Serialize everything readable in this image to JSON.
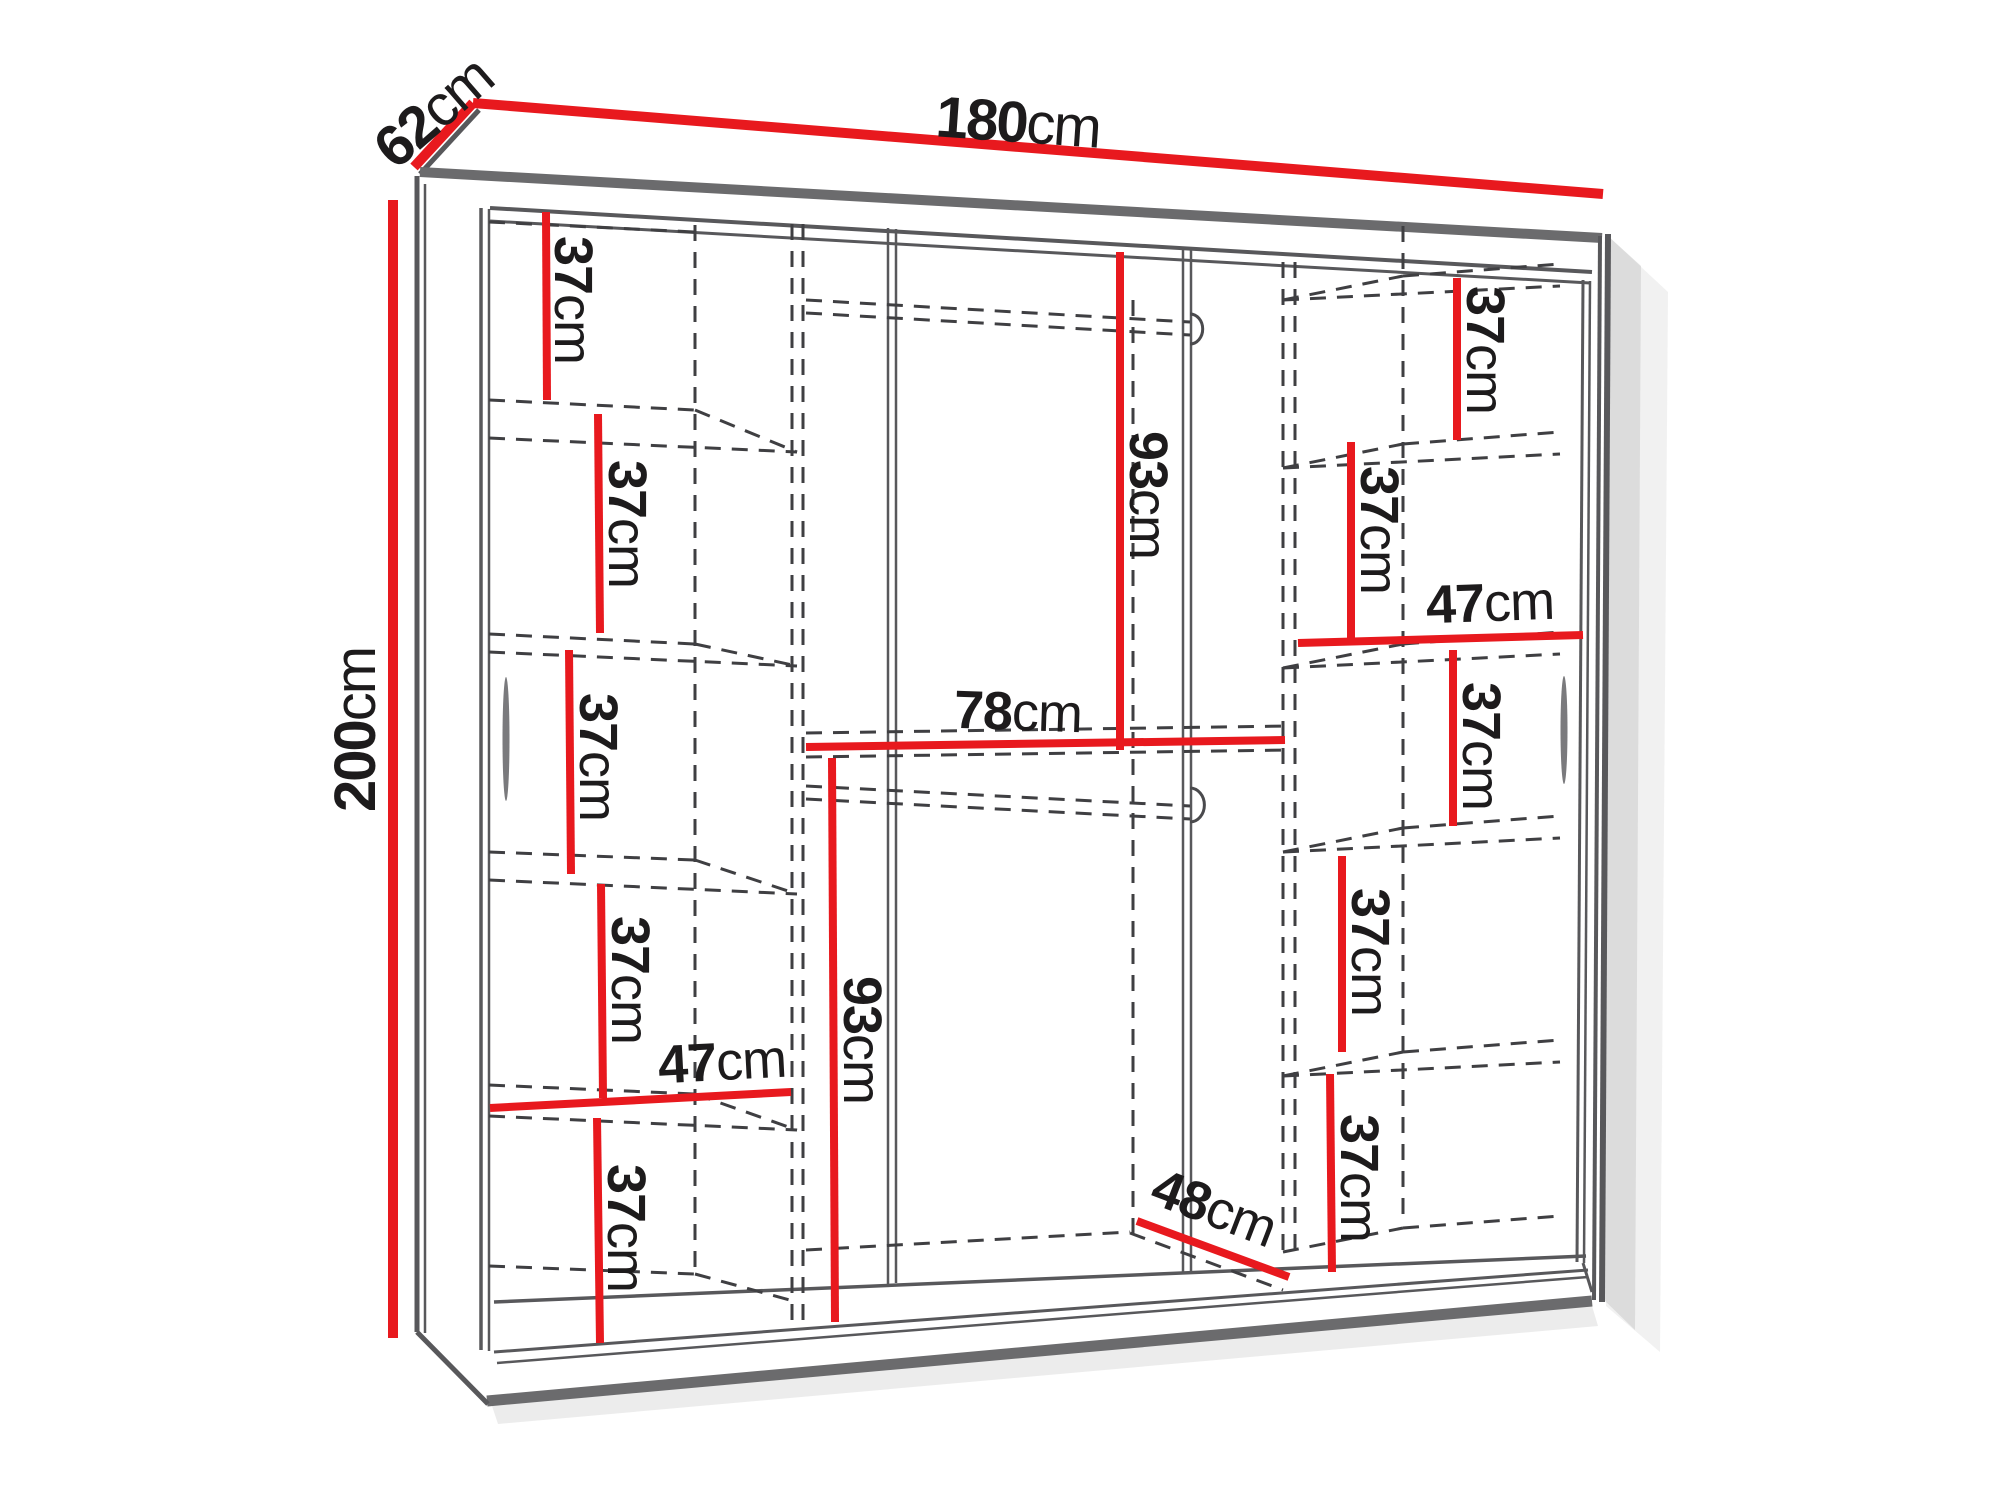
{
  "diagram": {
    "type": "furniture-dimension-diagram",
    "subject": "Sliding-door wardrobe front view with interior shelf layout and overall dimensions",
    "unit": "cm",
    "colors": {
      "dimension_red": "#e8191e",
      "outline_gray": "#58585b",
      "band_gray": "#6b6b6d",
      "dashed_gray": "#3f3f42",
      "text_black": "#1d1b1c",
      "background": "#ffffff"
    },
    "overall_dimensions": {
      "width_cm": 180,
      "depth_cm": 62,
      "height_cm": 200
    },
    "interior": {
      "left_column_shelf_heights_cm": [
        37,
        37,
        37,
        37,
        37
      ],
      "left_column_width_cm": 47,
      "hanging_section_upper_height_cm": 93,
      "hanging_section_lower_height_cm": 93,
      "hanging_section_width_cm": 78,
      "bottom_depth_cm": 48,
      "right_column_shelf_heights_cm": [
        37,
        37,
        37,
        37,
        37
      ],
      "right_column_width_cm": 47
    },
    "dims": [
      {
        "id": "width",
        "num": "180",
        "unit": "cm"
      },
      {
        "id": "depth",
        "num": "62",
        "unit": "cm"
      },
      {
        "id": "height",
        "num": "200",
        "unit": "cm"
      },
      {
        "id": "left-shelf-1",
        "num": "37",
        "unit": "cm"
      },
      {
        "id": "left-shelf-2",
        "num": "37",
        "unit": "cm"
      },
      {
        "id": "left-shelf-3",
        "num": "37",
        "unit": "cm"
      },
      {
        "id": "left-shelf-4",
        "num": "37",
        "unit": "cm"
      },
      {
        "id": "left-column-width",
        "num": "47",
        "unit": "cm"
      },
      {
        "id": "left-shelf-5",
        "num": "37",
        "unit": "cm"
      },
      {
        "id": "center-upper-height",
        "num": "93",
        "unit": "cm"
      },
      {
        "id": "center-width",
        "num": "78",
        "unit": "cm"
      },
      {
        "id": "center-lower-height",
        "num": "93",
        "unit": "cm"
      },
      {
        "id": "center-bottom-depth",
        "num": "48",
        "unit": "cm"
      },
      {
        "id": "right-shelf-1",
        "num": "37",
        "unit": "cm"
      },
      {
        "id": "right-shelf-2",
        "num": "37",
        "unit": "cm"
      },
      {
        "id": "right-column-width",
        "num": "47",
        "unit": "cm"
      },
      {
        "id": "right-shelf-3",
        "num": "37",
        "unit": "cm"
      },
      {
        "id": "right-shelf-4",
        "num": "37",
        "unit": "cm"
      },
      {
        "id": "right-shelf-5",
        "num": "37",
        "unit": "cm"
      }
    ]
  }
}
